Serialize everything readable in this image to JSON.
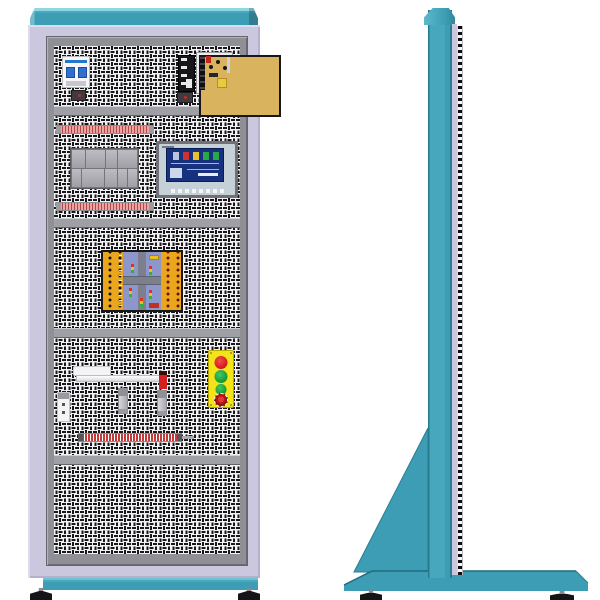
{
  "scene": {
    "subject": "industrial electrical training cabinet",
    "views": [
      "front",
      "side"
    ],
    "text_visible": false
  },
  "palette": {
    "teal": "#3d9db4",
    "teal_light": "#8ed7e2",
    "teal_dark": "#2a7d90",
    "frame_lavender": "#cbc7de",
    "inner_frame_gray": "#8f9096",
    "mesh_background": "#f1f1f3",
    "mesh_ink": "#17171a",
    "terminal_strip_pink": "#eaa4a4",
    "terminal_strip_red": "#c23a3a",
    "plc_rack_gray": "#a8a8ae",
    "hmi_screen_blue": "#16327e",
    "trainer_board_yellow": "#eaa71d",
    "trainer_board_blue": "#8e97cc",
    "psu_board_tan": "#d9b35e",
    "button_station_yellow": "#f2e418",
    "button_red": "#d81f1f",
    "button_green": "#18a038",
    "emergency_stop_red": "#8c0f0f",
    "foot_black": "#151517"
  },
  "front_view": {
    "mesh_sections": 5,
    "dividers": 4,
    "sections": [
      {
        "name": "power-bay",
        "components": [
          "circuit-breaker",
          "line-filter-relay",
          "open-frame-power-supply",
          "aux-widget",
          "aux-widget"
        ]
      },
      {
        "name": "control-bay",
        "components": [
          "terminal-strip",
          "plc-rack",
          "hmi-touch-panel",
          "terminal-strip"
        ]
      },
      {
        "name": "trainer-bay",
        "components": [
          "traffic-light-trainer-board"
        ]
      },
      {
        "name": "io-bay",
        "components": [
          "pneumatic-cylinder",
          "red-indicator",
          "limit-switch",
          "sensor",
          "sensor",
          "push-button-station",
          "terminal-strip"
        ]
      },
      {
        "name": "empty-bay",
        "components": []
      }
    ],
    "push_button_station": {
      "buttons": [
        "red",
        "green",
        "green",
        "emergency-stop"
      ]
    },
    "feet_count": 2
  },
  "side_view": {
    "components": [
      "top-cap",
      "column",
      "lavender-strip",
      "vent-strip",
      "support-gusset",
      "floor-base"
    ],
    "feet_count": 2
  }
}
